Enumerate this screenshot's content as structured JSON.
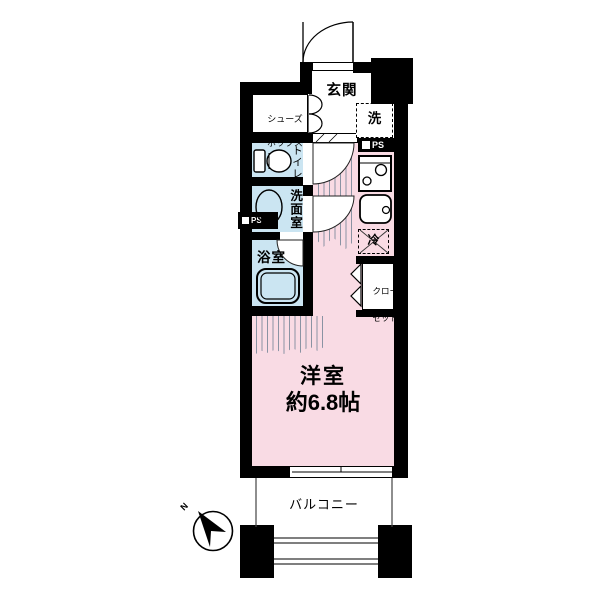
{
  "plan": {
    "entrance": "玄関",
    "shoe_box_line1": "シューズ",
    "shoe_box_line2": "ボックス",
    "washer": "洗",
    "ps": "PS",
    "toilet": "トイレ",
    "washroom": "洗面室",
    "bathroom": "浴室",
    "fridge": "冷",
    "closet_line1": "クロー",
    "closet_line2": "ゼット",
    "room_name": "洋室",
    "room_size": "約6.8帖",
    "balcony": "バルコニー",
    "compass_north": "N"
  },
  "colors": {
    "wall": "#000000",
    "wet_blue": "#cbe5f2",
    "room_pink": "#f9dbe4",
    "stripe": "#8a93a3",
    "thinline": "#444444"
  }
}
